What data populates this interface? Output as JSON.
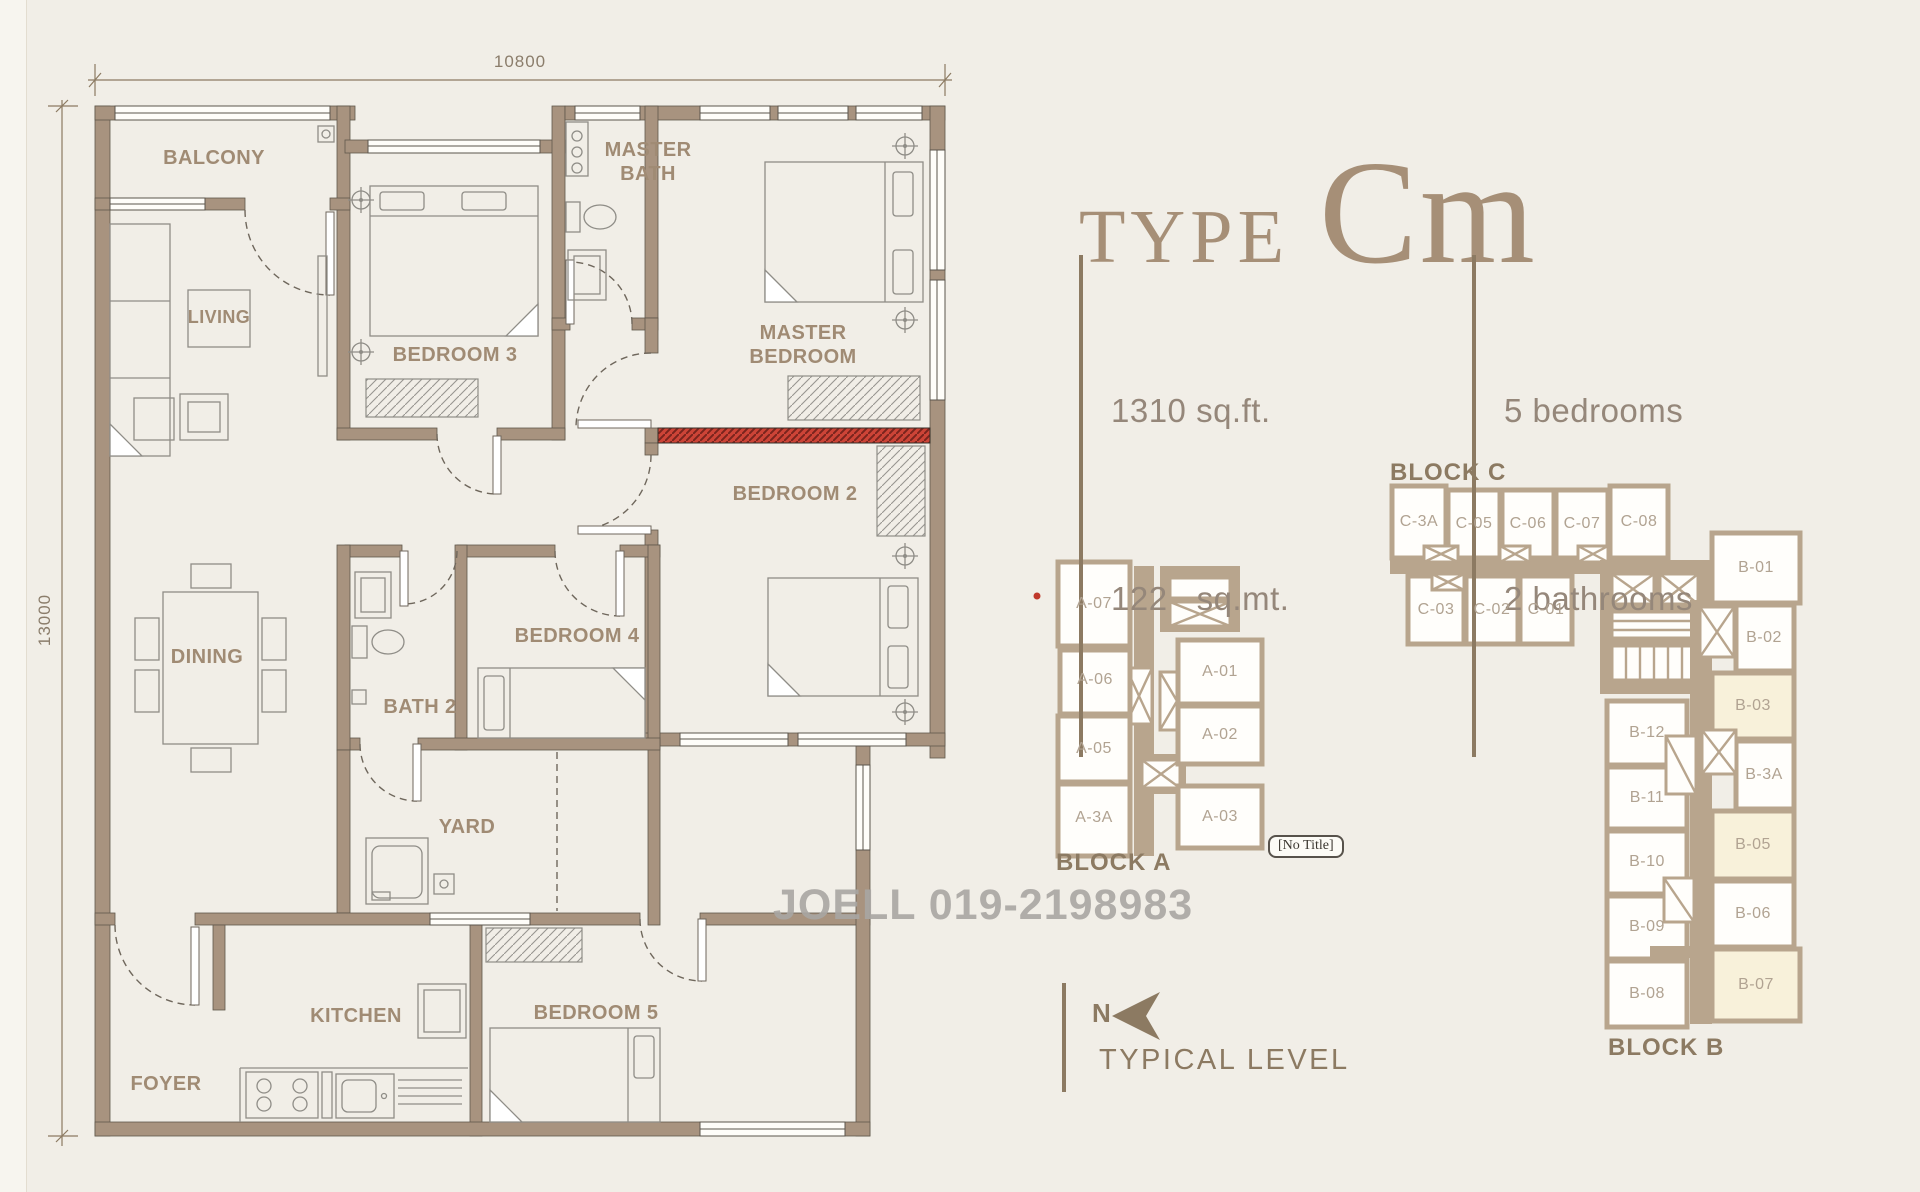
{
  "title": {
    "prefix": "TYPE",
    "code": "Cm"
  },
  "specs": {
    "area_imperial": "1310 sq.ft.",
    "area_metric": "122   sq.mt.",
    "bedrooms": "5 bedrooms",
    "bathrooms": "2 bathrooms"
  },
  "dimensions": {
    "top": "10800",
    "left": "13000"
  },
  "rooms": {
    "balcony": "BALCONY",
    "living": "LIVING",
    "bedroom3": "BEDROOM 3",
    "master_bath": "MASTER BATH",
    "master_bedroom": "MASTER BEDROOM",
    "bedroom2": "BEDROOM 2",
    "dining": "DINING",
    "bath2": "BATH 2",
    "bedroom4": "BEDROOM 4",
    "yard": "YARD",
    "kitchen": "KITCHEN",
    "foyer": "FOYER",
    "bedroom5": "BEDROOM 5"
  },
  "blocks": {
    "a": {
      "title": "BLOCK A",
      "units": {
        "a07": "A-07",
        "a06": "A-06",
        "a05": "A-05",
        "a3a": "A-3A",
        "a01": "A-01",
        "a02": "A-02",
        "a03": "A-03"
      }
    },
    "c": {
      "title": "BLOCK C",
      "units": {
        "c3a": "C-3A",
        "c05": "C-05",
        "c06": "C-06",
        "c07": "C-07",
        "c08": "C-08",
        "c03": "C-03",
        "c02": "C-02",
        "c01": "C-01"
      }
    },
    "b": {
      "title": "BLOCK B",
      "units": {
        "b01": "B-01",
        "b02": "B-02",
        "b03": "B-03",
        "b3a": "B-3A",
        "b05": "B-05",
        "b06": "B-06",
        "b07": "B-07",
        "b12": "B-12",
        "b11": "B-11",
        "b10": "B-10",
        "b09": "B-09",
        "b08": "B-08"
      },
      "highlighted_units": [
        "B-03",
        "B-05",
        "B-07"
      ]
    }
  },
  "watermark": "JOELL 019-2198983",
  "tooltip": "[No Title]",
  "compass_label": "N",
  "level_label": "TYPICAL LEVEL",
  "colors": {
    "background": "#f1eee7",
    "wall_tan": "#a8937f",
    "block_wall_tan": "#b8a58d",
    "accent_red_hatch": "#cd4437",
    "highlight_unit_cream": "#f8f1da",
    "label_brown": "#a08b74",
    "title_brown": "#a68f77",
    "watermark_gray": "#a9a6a3",
    "red_dot": "#c0392b"
  }
}
